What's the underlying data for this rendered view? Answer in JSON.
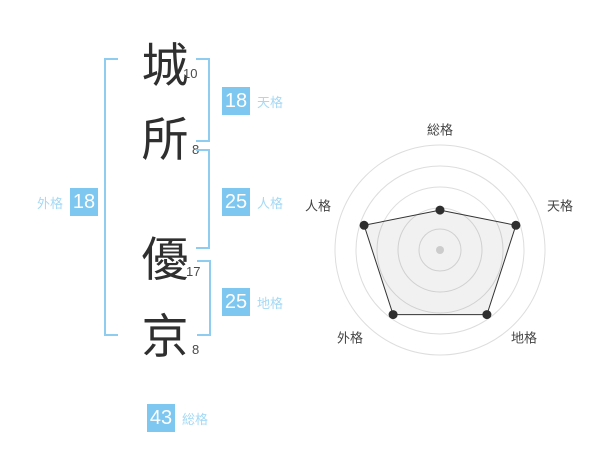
{
  "page": {
    "background": "#ffffff"
  },
  "name_panel": {
    "characters": [
      {
        "char": "城",
        "strokes": "10"
      },
      {
        "char": "所",
        "strokes": "8"
      },
      {
        "char": "優",
        "strokes": "17"
      },
      {
        "char": "京",
        "strokes": "8"
      }
    ],
    "badges": {
      "tenkaku": {
        "value": "18",
        "label": "天格"
      },
      "jinkaku": {
        "value": "25",
        "label": "人格"
      },
      "chikaku": {
        "value": "25",
        "label": "地格"
      },
      "gaikaku": {
        "value": "18",
        "label": "外格"
      },
      "soukaku": {
        "value": "43",
        "label": "総格"
      }
    },
    "colors": {
      "badge_bg": "#7dc7f0",
      "label_text": "#a5d9f5",
      "bracket": "#8fcdf0"
    }
  },
  "chart_data": {
    "type": "radar",
    "axes": [
      "総格",
      "天格",
      "地格",
      "外格",
      "人格"
    ],
    "values": [
      43,
      18,
      25,
      18,
      25
    ],
    "radii_fraction": [
      0.38,
      0.76,
      0.76,
      0.76,
      0.76
    ],
    "n_rings": 5,
    "grid": "circular",
    "legend": "none",
    "colors": {
      "ring": "#dddddd",
      "polygon_stroke": "#333333",
      "polygon_fill": "rgba(0,0,0,0.055)",
      "point": "#2e2e2e",
      "center_dot": "#cccccc",
      "axis_label": "#444444"
    }
  }
}
